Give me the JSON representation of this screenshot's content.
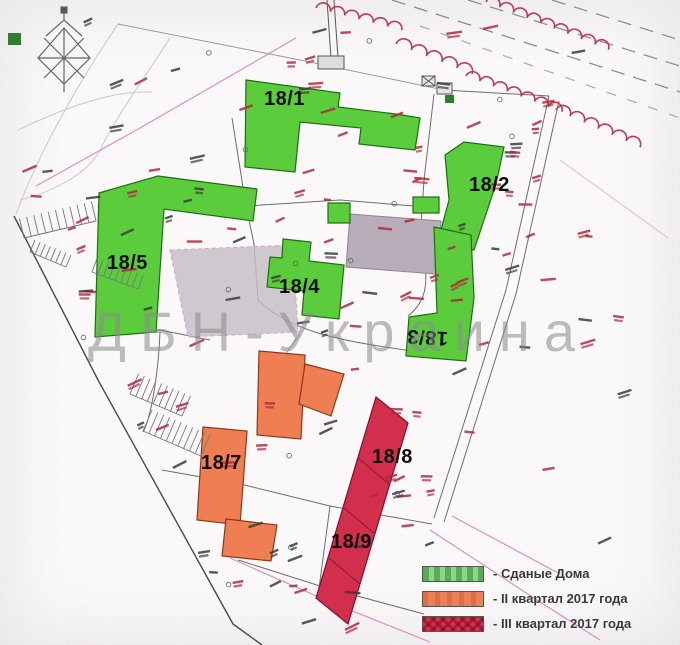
{
  "watermark": "ДБН-Украина",
  "buildings": [
    {
      "id": "18-1",
      "label": "18/1",
      "status": "delivered"
    },
    {
      "id": "18-2",
      "label": "18/2",
      "status": "delivered"
    },
    {
      "id": "18-3",
      "label": "18/3",
      "status": "delivered"
    },
    {
      "id": "18-4",
      "label": "18/4",
      "status": "delivered"
    },
    {
      "id": "18-5",
      "label": "18/5",
      "status": "delivered"
    },
    {
      "id": "18-7",
      "label": "18/7",
      "status": "q2-2017"
    },
    {
      "id": "18-8",
      "label": "18/8",
      "status": "q3-2017"
    },
    {
      "id": "18-9",
      "label": "18/9",
      "status": "q3-2017"
    }
  ],
  "legend": {
    "items": [
      {
        "label": "- Сданые Дома",
        "color": "#8fd487"
      },
      {
        "label": "- II квартал 2017 года",
        "color": "#ee8057"
      },
      {
        "label": "- III квартал 2017 года",
        "color": "#d1314e"
      }
    ]
  },
  "colors": {
    "delivered": "#5bcd3c",
    "q2_2017": "#ef7e52",
    "q3_2017": "#d32e4c",
    "gray_area": "#b7aeb9",
    "gray_area_light": "#c5bec6",
    "annotation_red": "#b3283d",
    "annotation_dark": "#3c3c3c",
    "slope_red": "#c23a50",
    "utility_pink": "#dc8fc0"
  }
}
